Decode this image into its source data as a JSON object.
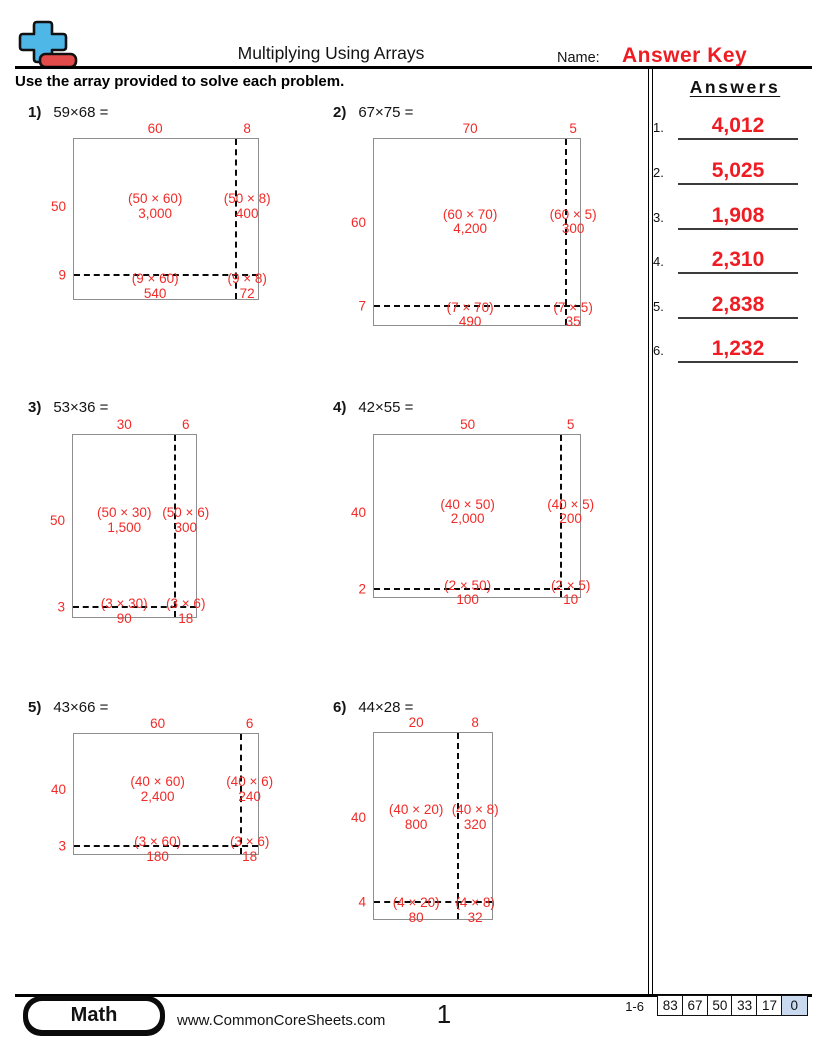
{
  "header": {
    "title": "Multiplying Using Arrays",
    "name_label": "Name:",
    "name_value": "Answer Key"
  },
  "instruction": "Use the array provided to solve each problem.",
  "answers": {
    "title": "Answers",
    "items": [
      {
        "num": "1.",
        "value": "4,012"
      },
      {
        "num": "2.",
        "value": "5,025"
      },
      {
        "num": "3.",
        "value": "1,908"
      },
      {
        "num": "4.",
        "value": "2,310"
      },
      {
        "num": "5.",
        "value": "2,838"
      },
      {
        "num": "6.",
        "value": "1,232"
      }
    ]
  },
  "problems": [
    {
      "num": "1)",
      "expression": "59×68 =",
      "top_labels": [
        "60",
        "8"
      ],
      "side_labels": [
        "50",
        "9"
      ],
      "cells": [
        {
          "formula": "(50 × 60)",
          "product": "3,000"
        },
        {
          "formula": "(50 × 8)",
          "product": "400"
        },
        {
          "formula": "(9 × 60)",
          "product": "540"
        },
        {
          "formula": "(9 × 8)",
          "product": "72"
        }
      ]
    },
    {
      "num": "2)",
      "expression": "67×75 =",
      "top_labels": [
        "70",
        "5"
      ],
      "side_labels": [
        "60",
        "7"
      ],
      "cells": [
        {
          "formula": "(60 × 70)",
          "product": "4,200"
        },
        {
          "formula": "(60 × 5)",
          "product": "300"
        },
        {
          "formula": "(7 × 70)",
          "product": "490"
        },
        {
          "formula": "(7 × 5)",
          "product": "35"
        }
      ]
    },
    {
      "num": "3)",
      "expression": "53×36 =",
      "top_labels": [
        "30",
        "6"
      ],
      "side_labels": [
        "50",
        "3"
      ],
      "cells": [
        {
          "formula": "(50 × 30)",
          "product": "1,500"
        },
        {
          "formula": "(50 × 6)",
          "product": "300"
        },
        {
          "formula": "(3 × 30)",
          "product": "90"
        },
        {
          "formula": "(3 × 6)",
          "product": "18"
        }
      ]
    },
    {
      "num": "4)",
      "expression": "42×55 =",
      "top_labels": [
        "50",
        "5"
      ],
      "side_labels": [
        "40",
        "2"
      ],
      "cells": [
        {
          "formula": "(40 × 50)",
          "product": "2,000"
        },
        {
          "formula": "(40 × 5)",
          "product": "200"
        },
        {
          "formula": "(2 × 50)",
          "product": "100"
        },
        {
          "formula": "(2 × 5)",
          "product": "10"
        }
      ]
    },
    {
      "num": "5)",
      "expression": "43×66 =",
      "top_labels": [
        "60",
        "6"
      ],
      "side_labels": [
        "40",
        "3"
      ],
      "cells": [
        {
          "formula": "(40 × 60)",
          "product": "2,400"
        },
        {
          "formula": "(40 × 6)",
          "product": "240"
        },
        {
          "formula": "(3 × 60)",
          "product": "180"
        },
        {
          "formula": "(3 × 6)",
          "product": "18"
        }
      ]
    },
    {
      "num": "6)",
      "expression": "44×28 =",
      "top_labels": [
        "20",
        "8"
      ],
      "side_labels": [
        "40",
        "4"
      ],
      "cells": [
        {
          "formula": "(40 × 20)",
          "product": "800"
        },
        {
          "formula": "(40 × 8)",
          "product": "320"
        },
        {
          "formula": "(4 × 20)",
          "product": "80"
        },
        {
          "formula": "(4 × 8)",
          "product": "32"
        }
      ]
    }
  ],
  "footer": {
    "brand": "Math",
    "website": "www.CommonCoreSheets.com",
    "page_number": "1",
    "range": "1-6",
    "scores": [
      "83",
      "67",
      "50",
      "33",
      "17",
      "0"
    ]
  },
  "colors": {
    "accent_red": "#f02b28",
    "answer_red": "#ee1d23",
    "score_highlight_blue": "#c9daf0",
    "logo_blue": "#4fb6e8",
    "logo_red": "#e34b4a",
    "rect_border_gray": "#8e8e8e"
  }
}
